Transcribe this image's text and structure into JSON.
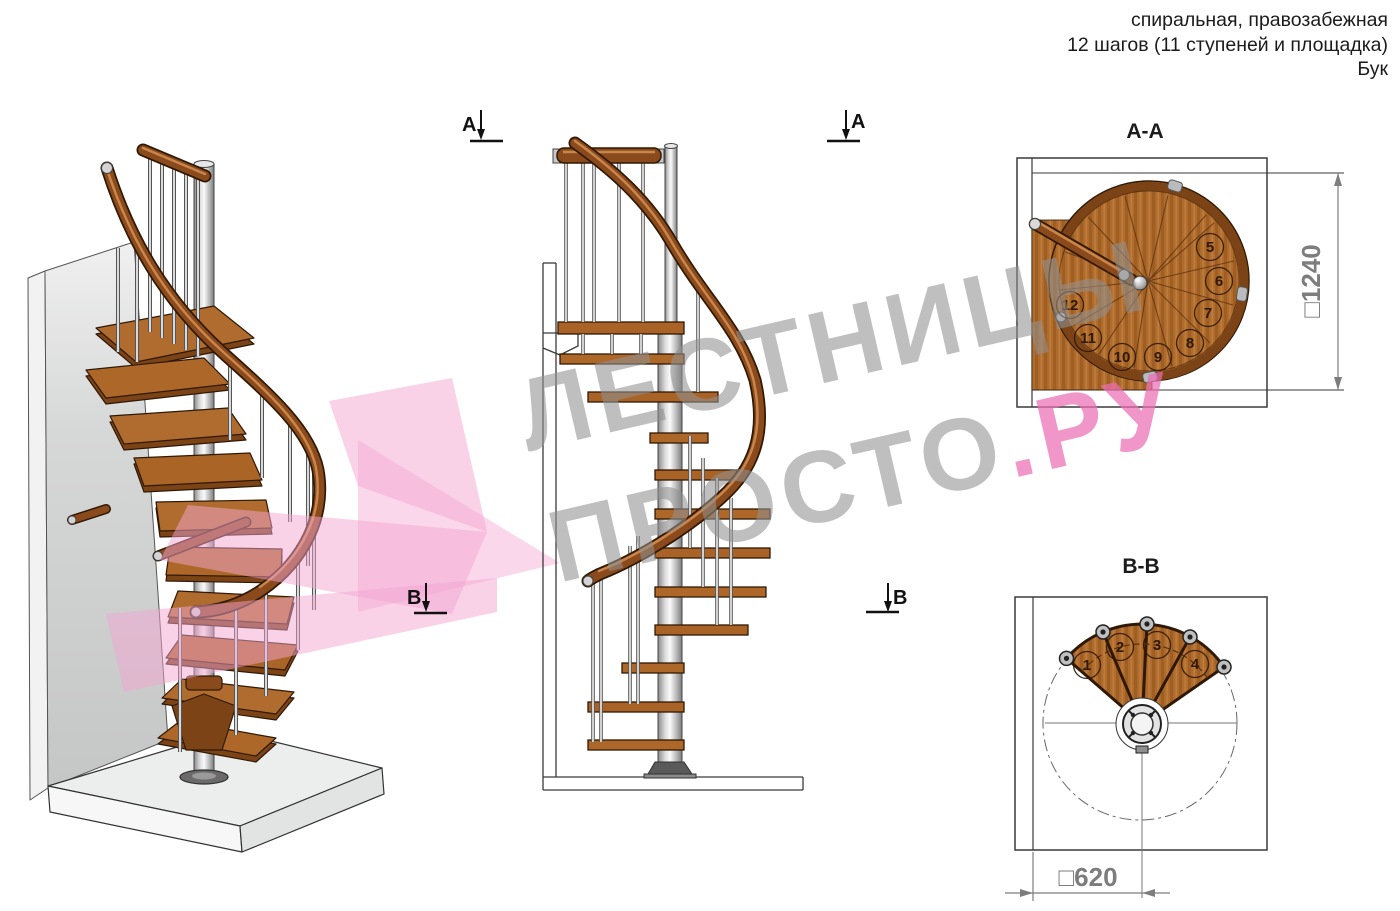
{
  "header": {
    "line1": "спиральная, правозабежная",
    "line2": "12 шагов (11 ступеней и площадка)",
    "line3": "Бук"
  },
  "watermark": {
    "line1": "ЛЕСТНИЦЫ",
    "line2_gray": "ПРОСТО",
    "line2_pink": ".РУ"
  },
  "views": {
    "aa": {
      "title": "A-A",
      "dimension": "□1240",
      "numbers": [
        "5",
        "6",
        "7",
        "8",
        "9",
        "10",
        "11",
        "12"
      ]
    },
    "bb": {
      "title": "B-B",
      "dimension": "□620",
      "numbers": [
        "1",
        "2",
        "3",
        "4"
      ]
    }
  },
  "markers": {
    "a": "A",
    "b": "B"
  },
  "colors": {
    "wood": "#a96327",
    "wood_dark": "#7b4316",
    "outline": "#2f1905",
    "metal": "#c8c8c8",
    "pink_ribbon": "#f3a6d2",
    "watermark_gray": "#919191",
    "watermark_pink": "#ec6eb4"
  }
}
